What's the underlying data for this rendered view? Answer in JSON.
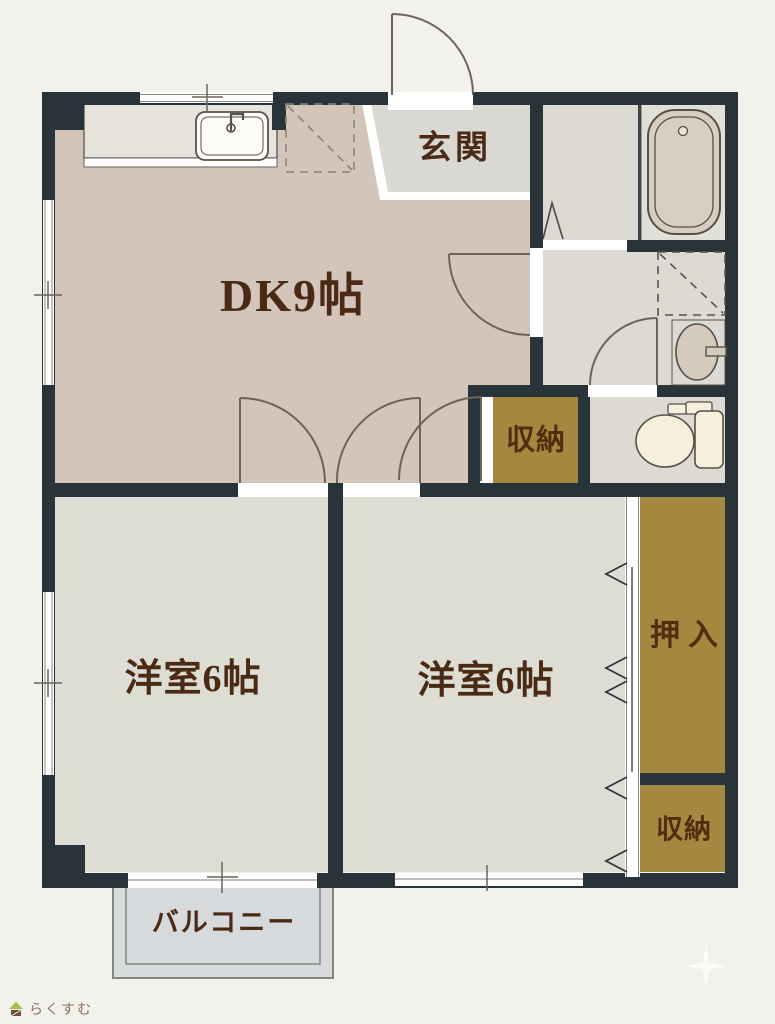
{
  "page": {
    "background": "#f3f1eb"
  },
  "plan": {
    "rooms": {
      "dk": {
        "label": "DK9帖"
      },
      "genkan": {
        "label": "玄関"
      },
      "bedroom1": {
        "label": "洋室6帖"
      },
      "bedroom2": {
        "label": "洋室6帖"
      },
      "closet_mid": {
        "label": "収納"
      },
      "oshiire": {
        "label": "押入"
      },
      "closet_br": {
        "label": "収納"
      },
      "balcony": {
        "label": "バルコニー"
      }
    },
    "icons": [
      "kitchen-sink-icon",
      "refrigerator-space-icon",
      "bathtub-icon",
      "washing-machine-space-icon",
      "washbasin-icon",
      "toilet-icon",
      "door-swing-arc",
      "sliding-door-chevron",
      "window-tick",
      "sparkle-icon",
      "house-logo-icon"
    ],
    "colors": {
      "wall": "#29343a",
      "dk_floor": "#d3c5b9",
      "bedroom_floor": "#deddd4",
      "service_floor": "#dcdad2",
      "bath_floor": "#e0dfd8",
      "genkan_floor": "#d9d8d2",
      "storage_gold": "#a5883f",
      "balcony_floor": "#d7dadd",
      "counter": "#e6e4dd",
      "fixture_cream": "#f5efdb",
      "label_text": "#4b2a15"
    }
  },
  "branding": {
    "logo_text": "らくすむ"
  }
}
